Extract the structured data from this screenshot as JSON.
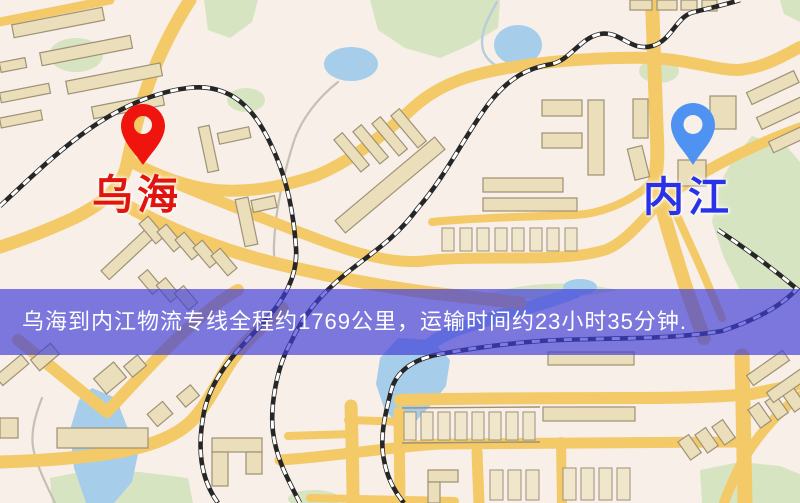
{
  "banner": {
    "text": "乌海到内江物流专线全程约1769公里，运输时间约23小时35分钟."
  },
  "markers": [
    {
      "id": "wuhai",
      "label": "乌海",
      "pin_icon": "red-map-pin"
    },
    {
      "id": "neijiang",
      "label": "内江",
      "pin_icon": "blue-map-pin"
    }
  ],
  "colors": {
    "map_bg": "#f7efe8",
    "road": "#f3ca67",
    "water": "#a6cdea",
    "park": "#d7e4c1",
    "building": "#eadfba",
    "building_stroke": "#9f9176",
    "railway": "#262626",
    "banner_bg": "rgba(64,62,215,0.68)",
    "banner_text": "#ffffff",
    "wuhai_label": "#e01510",
    "neijiang_label": "#2a32e8",
    "pin_red": "#f0140e",
    "pin_blue": "#4f93f2"
  }
}
